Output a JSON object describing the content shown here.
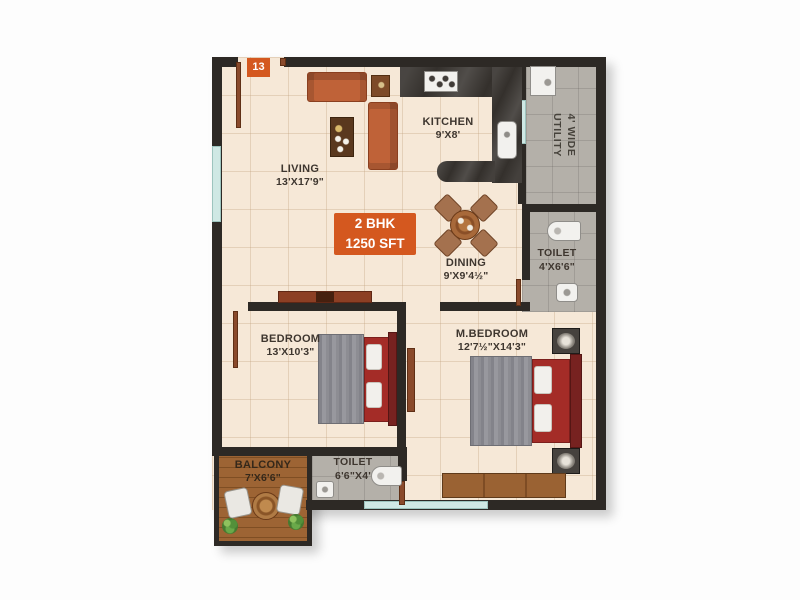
{
  "unit": {
    "number_badge": "13",
    "type_line1": "2 BHK",
    "type_line2": "1250 SFT"
  },
  "rooms": {
    "living": {
      "name": "LIVING",
      "size": "13'X17'9\""
    },
    "kitchen": {
      "name": "KITCHEN",
      "size": "9'X8'"
    },
    "dining": {
      "name": "DINING",
      "size": "9'X9'4½\""
    },
    "utility": {
      "line1": "4' WIDE",
      "line2": "UTILITY"
    },
    "toilet_attached": {
      "name": "TOILET",
      "size": "4'X6'6\""
    },
    "bedroom": {
      "name": "BEDROOM",
      "size": "13'X10'3\""
    },
    "master_bedroom": {
      "name": "M.BEDROOM",
      "size": "12'7½\"X14'3\""
    },
    "balcony": {
      "name": "BALCONY",
      "size": "7'X6'6\""
    },
    "toilet_common": {
      "name": "TOILET",
      "size": "6'6\"X4'"
    }
  },
  "colors": {
    "accent_orange": "#d4581f",
    "wall_dark": "#2d2925",
    "floor_cream": "#f6e8d7",
    "floor_wet_gray": "#b4b0a9",
    "balcony_wood": "#9a6233",
    "bed_red": "#a42c27",
    "sofa_orange": "#bf6238",
    "window_glass": "#cfe8e4"
  }
}
